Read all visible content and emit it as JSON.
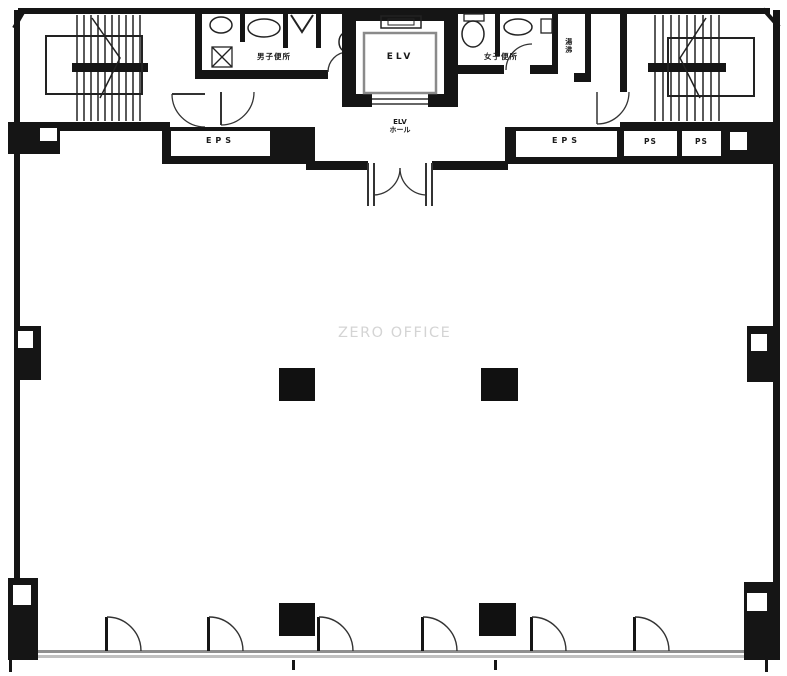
{
  "plan": {
    "watermark": "ZERO OFFICE",
    "labels": {
      "men_toilet": "男子便所",
      "women_toilet": "女子便所",
      "elevator_shaft": "ELV",
      "elevator_hall_line1": "ELV",
      "elevator_hall_line2": "ホール",
      "eps_left": "EPS",
      "eps_right": "EPS",
      "ps_1": "PS",
      "ps_2": "PS",
      "hot_water": "湯沸"
    },
    "colors": {
      "wall": "#151515",
      "exterior_line": "#8f8f8f",
      "elevator_car_outline": "#8a8a8a",
      "watermark": "#d4d4d4"
    }
  }
}
